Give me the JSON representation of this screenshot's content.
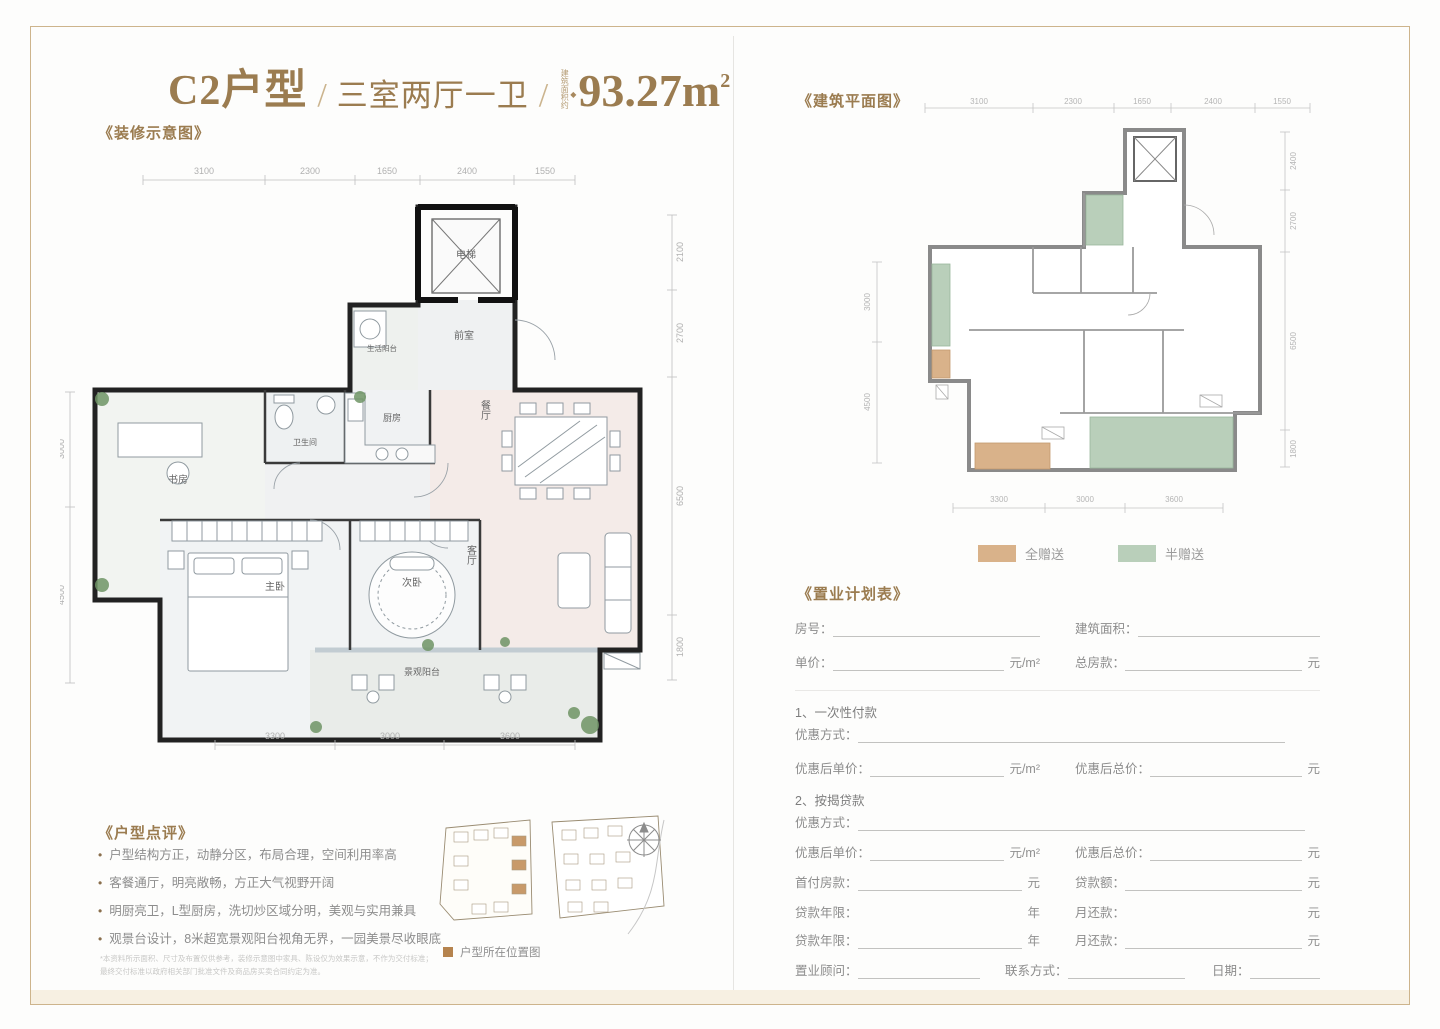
{
  "header": {
    "unit_type": "C2户型",
    "sep1": "/",
    "layout": "三室两厅一卫",
    "sep2": "/",
    "area_prefix": "建筑面积约",
    "area_diamond": "◆",
    "area_value": "93.27m",
    "area_sup": "2"
  },
  "deco_plan": {
    "section_label": "《装修示意图》",
    "dims_top": [
      "3100",
      "2300",
      "1650",
      "2400",
      "1550"
    ],
    "dims_left": [
      "3000",
      "4500"
    ],
    "dims_right": [
      "2100",
      "2700",
      "6500",
      "1800"
    ],
    "dims_bottom": [
      "3300",
      "3000",
      "3600"
    ],
    "rooms": {
      "elevator": "电梯",
      "foyer": "前室",
      "service_balcony": "生活阳台",
      "kitchen": "厨房",
      "bathroom": "卫生间",
      "study": "书房",
      "dining": "餐厅",
      "living": "客厅",
      "master_bedroom": "主卧",
      "second_bedroom": "次卧",
      "view_balcony": "景观阳台"
    }
  },
  "arch_plan": {
    "section_label": "《建筑平面图》",
    "dims_top": [
      "3100",
      "2300",
      "1650",
      "2400",
      "1550"
    ],
    "dims_left": [
      "3000",
      "4500"
    ],
    "dims_right": [
      "2400",
      "2700",
      "6500",
      "1800"
    ],
    "dims_bottom": [
      "3300",
      "3000",
      "3600"
    ],
    "legend": [
      {
        "label": "全赠送",
        "color": "#d9b28a"
      },
      {
        "label": "半赠送",
        "color": "#b9cfba"
      }
    ]
  },
  "review": {
    "heading": "《户型点评》",
    "bullets": [
      "户型结构方正，动静分区，布局合理，空间利用率高",
      "客餐通厅，明亮敞畅，方正大气视野开阔",
      "明厨亮卫，L型厨房，洗切炒区域分明，美观与实用兼具",
      "观景台设计，8米超宽景观阳台视角无界，一园美景尽收眼底"
    ]
  },
  "location_map": {
    "caption": "户型所在位置图"
  },
  "disclaimer": {
    "line1": "*本资料所示面积、尺寸及布置仅供参考，装修示意图中家具、陈设仅为效果示意，不作为交付标准；",
    "line2": "最终交付标准以政府相关部门批准文件及商品房买卖合同约定为准。"
  },
  "plan_form": {
    "heading": "《置业计划表》",
    "fields": {
      "room_no": "房号：",
      "build_area": "建筑面积：",
      "unit_price": "单价：",
      "unit_price_unit": "元/m²",
      "total_price": "总房款：",
      "total_price_unit": "元",
      "sec1": "1、一次性付款",
      "discount1": "优惠方式：",
      "disc_unit_price": "优惠后单价：",
      "disc_unit_price_unit": "元/m²",
      "disc_total_price": "优惠后总价：",
      "disc_total_price_unit": "元",
      "sec2": "2、按揭贷款",
      "discount2": "优惠方式：",
      "down_payment": "首付房款：",
      "down_payment_unit": "元",
      "loan_amount": "贷款额：",
      "loan_amount_unit": "元",
      "loan_years": "贷款年限：",
      "loan_years_unit": "年",
      "monthly_payment": "月还款：",
      "monthly_payment_unit": "元",
      "loan_years2": "贷款年限：",
      "loan_years2_unit": "年",
      "monthly_payment2": "月还款：",
      "monthly_payment2_unit": "元",
      "consultant": "置业顾问：",
      "contact": "联系方式：",
      "date": "日期："
    }
  }
}
